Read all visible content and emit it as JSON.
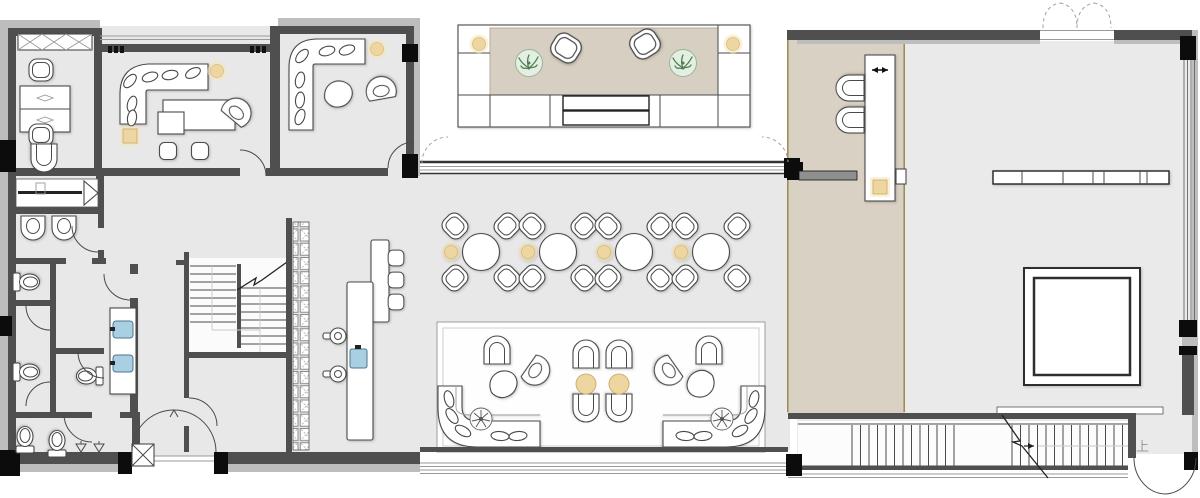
{
  "drawing": {
    "kind": "architectural-floor-plan",
    "labels": {
      "stairs_up": "上"
    },
    "colors": {
      "paper": "#ffffff",
      "floor": "#e8e8e8",
      "floor-dim": "#eaeaea",
      "wall": "#4f4f4f",
      "wall-light": "#bdbdbd",
      "column": "#0c0c0c",
      "line": "#4a4a4a",
      "line-soft": "#9a9a9a",
      "tan-floor": "#d9d1c3",
      "tan-table": "#d7cfc1",
      "olive": "#9a8950",
      "lamp": "#eed6a0",
      "lamp-glow": "#f6e3b4",
      "plant": "#4e7d4e",
      "plant-bg": "#e3efe2",
      "sink": "#a9cfe2",
      "white": "#ffffff"
    }
  }
}
